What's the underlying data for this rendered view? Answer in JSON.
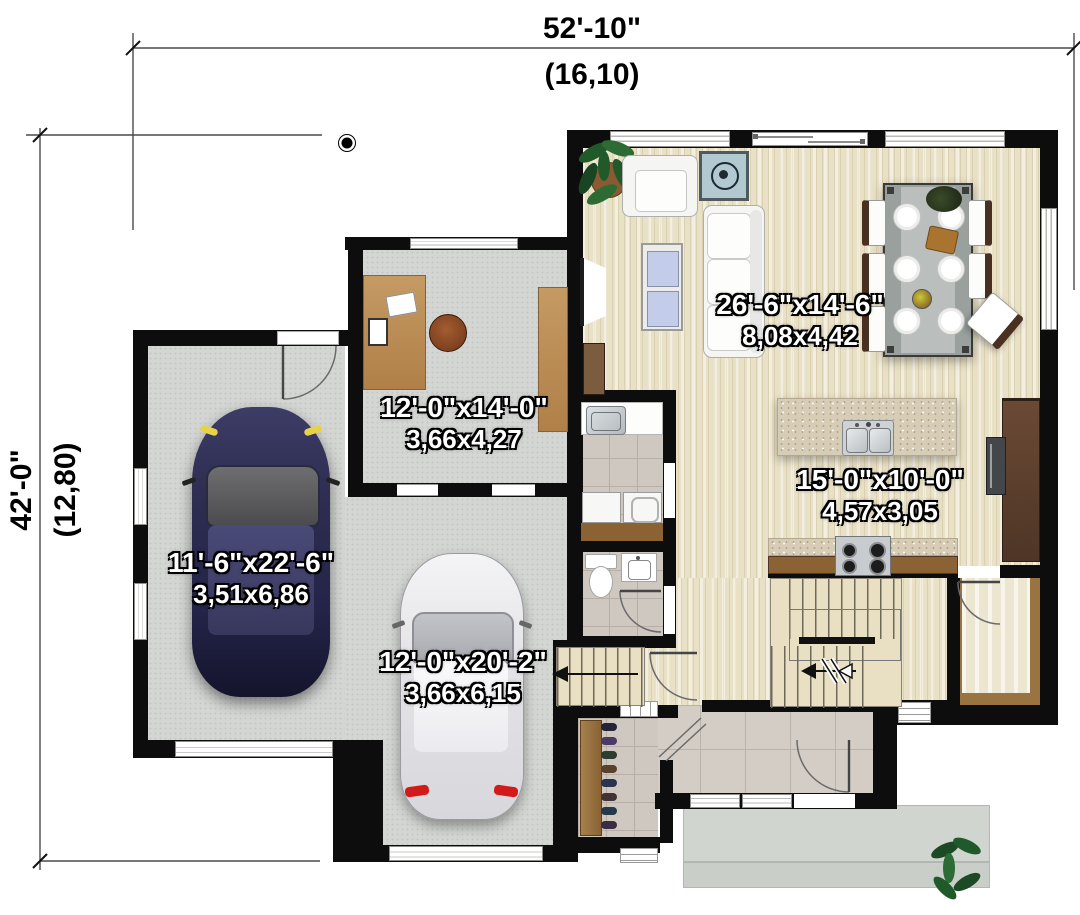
{
  "dim": {
    "w_ft": "52'-10\"",
    "w_m": "(16,10)",
    "h_ft": "42'-0\"",
    "h_m": "(12,80)"
  },
  "rooms": {
    "living": {
      "ft": "26'-6\"x14'-6\"",
      "m": "8,08x4,42"
    },
    "kitchen": {
      "ft": "15'-0\"x10'-0\"",
      "m": "4,57x3,05"
    },
    "office": {
      "ft": "12'-0\"x14'-0\"",
      "m": "3,66x4,27"
    },
    "garage1": {
      "ft": "11'-6\"x22'-6\"",
      "m": "3,51x6,86"
    },
    "garage2": {
      "ft": "12'-0\"x20'-2\"",
      "m": "3,66x6,15"
    }
  },
  "colors": {
    "wall": "#0d0d0d",
    "wood_floor": "#e9e1c6",
    "concrete_floor": "#d4d6d4",
    "tile_floor": "#cfc8c1",
    "granite_counter": "#d7cdb6",
    "cabinet_brown": "#6b4a35",
    "desk_wood": "#c59a63",
    "car_blue": "#34345c",
    "car_white": "#ededef",
    "stove_teal": "#b2c9d2",
    "plant_green": "#215a2a",
    "label_text": "#ffffff",
    "dimension_text": "#000000"
  }
}
